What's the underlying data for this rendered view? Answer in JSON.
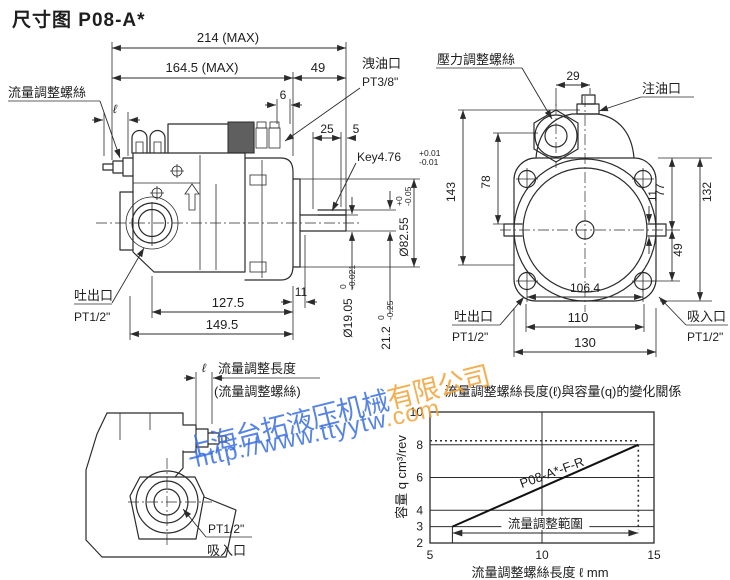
{
  "page": {
    "title": "尺寸图 P08-A*"
  },
  "colors": {
    "line": "#2b2b2b",
    "watermark_blue": "#3a6fe0",
    "watermark_orange": "#f2a233"
  },
  "watermark": {
    "line1_blue": "上海台拓液压机械",
    "line1_orange": "有限公司",
    "line2_blue": "http://www.ttyytw",
    "line2_orange": ".com"
  },
  "side_view": {
    "flow_screw_label": "流量調整螺絲",
    "ell": "ℓ",
    "dim_overall": "214 (MAX)",
    "dim_body": "164.5 (MAX)",
    "dim_rear": "49",
    "dim_6": "6",
    "drain_port": "洩油口",
    "drain_port_size": "PT3/8\"",
    "dim_25": "25",
    "dim_5": "5",
    "key": "Key4.76",
    "key_tol_up": "+0.01",
    "key_tol_dn": "-0.01",
    "pilot_dia": "Ø82.55",
    "pilot_tol_up": "+0",
    "pilot_tol_dn": "-0.05",
    "shaft_dia": "Ø19.05",
    "shaft_tol_up": "0",
    "shaft_tol_dn": "-0.021",
    "key_height": "21.2",
    "key_height_tol_up": "0",
    "key_height_tol_dn": "-0.25",
    "dim_11": "11",
    "dim_127_5": "127.5",
    "dim_149_5": "149.5",
    "outlet_port": "吐出口",
    "outlet_port_size": "PT1/2\""
  },
  "front_view": {
    "pressure_screw_label": "壓力調整螺絲",
    "dim_29": "29",
    "fill_port": "注油口",
    "dim_78": "78",
    "dim_143": "143",
    "dim_77": "77",
    "dim_11": "11",
    "dim_49": "49",
    "dim_132": "132",
    "dim_106_4": "106.4",
    "dim_110": "110",
    "dim_130": "130",
    "outlet_port": "吐出口",
    "outlet_port_size": "PT1/2\"",
    "inlet_port": "吸入口",
    "inlet_port_size": "PT1/2\""
  },
  "adjust_view": {
    "ell": "ℓ",
    "adjust_length_label": "流量調整長度",
    "adjust_screw_label": "(流量調整螺絲)",
    "inlet_port_size": "PT1/2\"",
    "inlet_port": "吸入口"
  },
  "chart_data": {
    "type": "line",
    "title": "流量調整螺絲長度(ℓ)與容量(q)的變化關係",
    "xlabel": "流量調整螺絲長度 ℓ mm",
    "ylabel": "容量 q cm³/rev",
    "xlim": [
      5,
      15
    ],
    "ylim": [
      2,
      10
    ],
    "xticks": [
      5,
      10,
      15
    ],
    "yticks": [
      2,
      3,
      4,
      6,
      8,
      10
    ],
    "grid": true,
    "legend_position": "on-line",
    "series": [
      {
        "name": "P08-A*-F-R",
        "points": [
          [
            6,
            3
          ],
          [
            14.3,
            8
          ]
        ]
      }
    ],
    "range_annotation": {
      "label": "流量調整範圍",
      "x_from": 6,
      "x_to": 14.3,
      "y": 2.6
    },
    "guides": {
      "h_dotted_y": 8,
      "v_dotted_x": 14.3
    }
  }
}
